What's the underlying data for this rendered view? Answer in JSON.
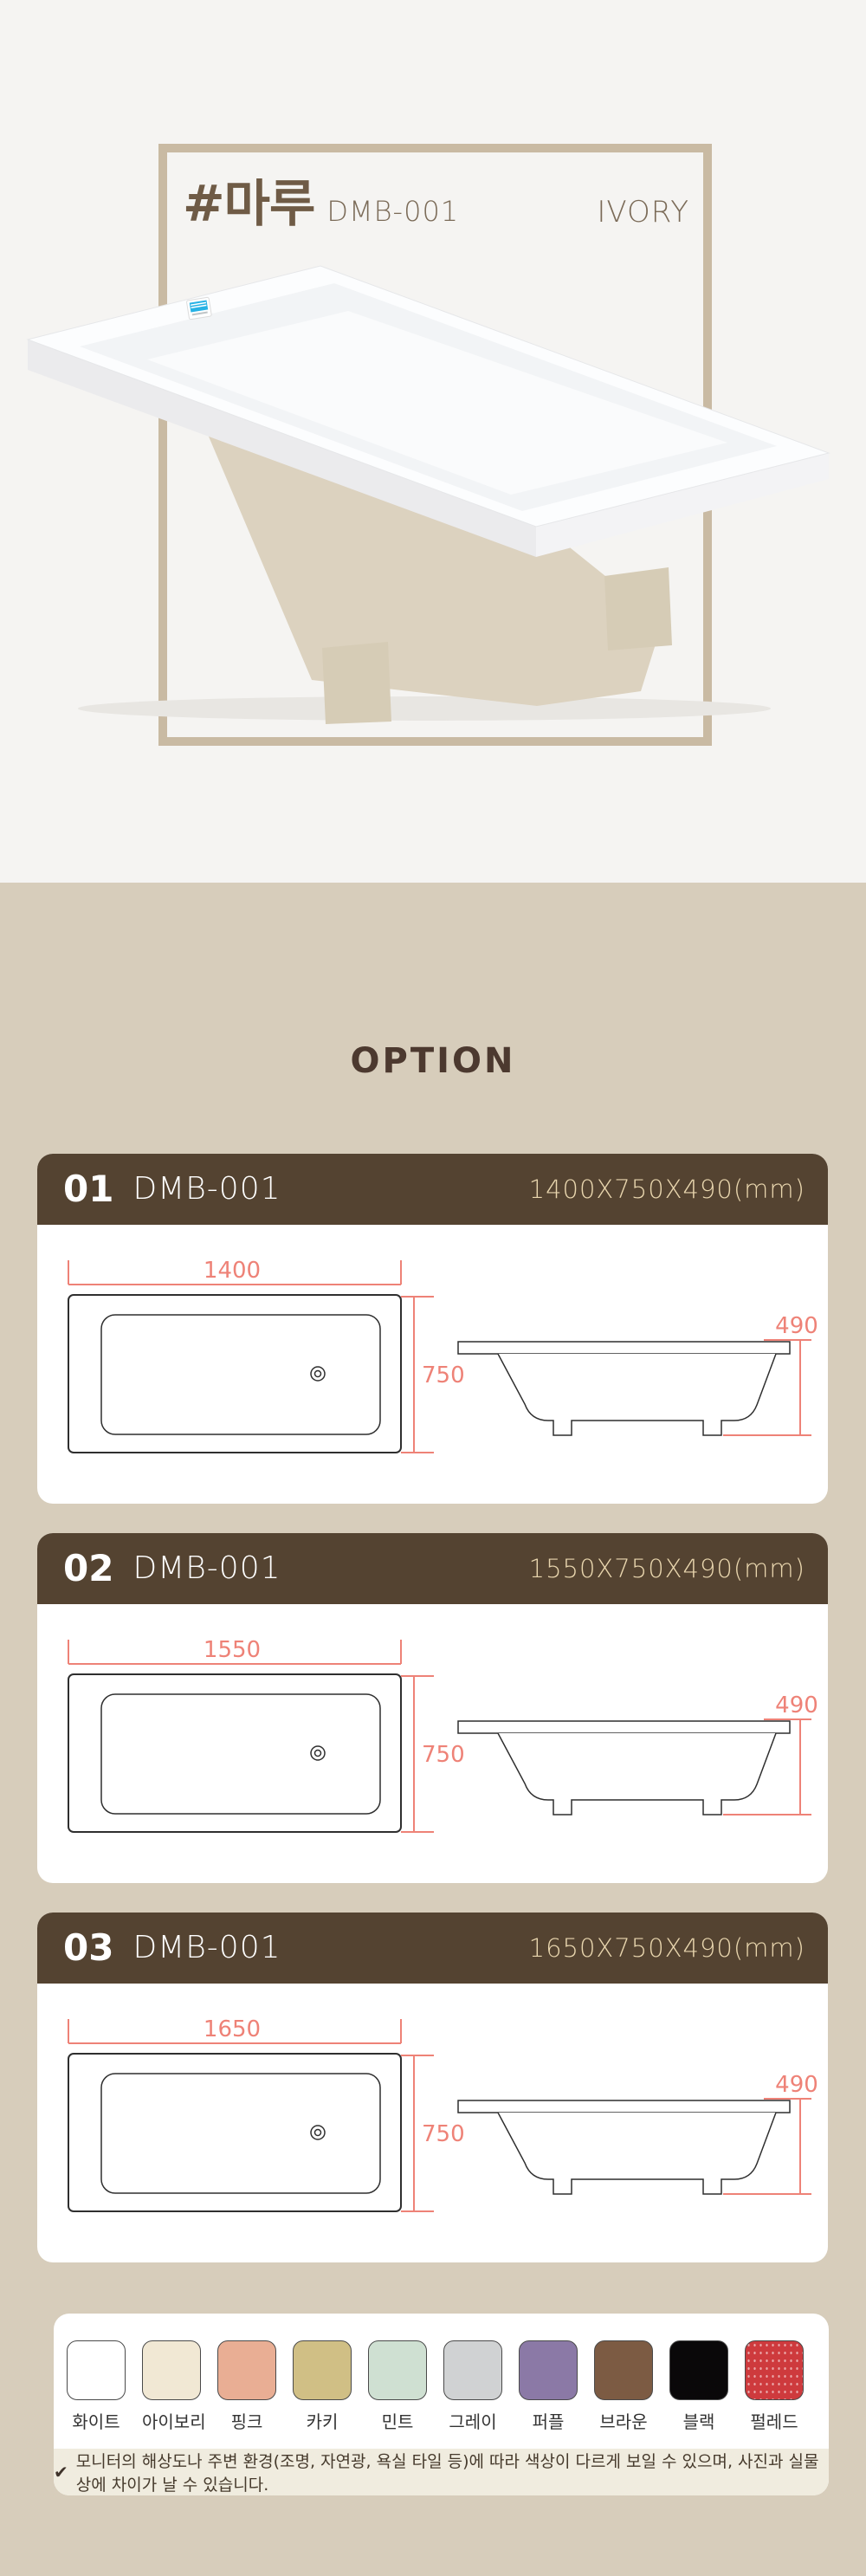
{
  "colors": {
    "page_top_bg": "#f5f4f2",
    "section_bg": "#d7cdbb",
    "frame_border": "#c9baa3",
    "card_header_bg": "#544331",
    "dimension_accent": "#ee8277",
    "size_text": "#e9d6ae",
    "title_brown": "#6f5b46",
    "option_title_color": "#4c392f",
    "note_bar_bg": "#f0ecdf"
  },
  "header": {
    "hash_title": "#마루",
    "model": "DMB-001",
    "finish_label": "IVORY"
  },
  "section_title": "OPTION",
  "options": [
    {
      "number": "01",
      "model": "DMB-001",
      "size": "1400X750X490(mm)",
      "top_width": "1400",
      "top_depth": "750",
      "side_height": "490"
    },
    {
      "number": "02",
      "model": "DMB-001",
      "size": "1550X750X490(mm)",
      "top_width": "1550",
      "top_depth": "750",
      "side_height": "490"
    },
    {
      "number": "03",
      "model": "DMB-001",
      "size": "1650X750X490(mm)",
      "top_width": "1650",
      "top_depth": "750",
      "side_height": "490"
    }
  ],
  "palette": {
    "swatches": [
      {
        "label": "화이트",
        "color": "#ffffff"
      },
      {
        "label": "아이보리",
        "color": "#f1e8d4"
      },
      {
        "label": "핑크",
        "color": "#e9ae94"
      },
      {
        "label": "카키",
        "color": "#d0bf85"
      },
      {
        "label": "민트",
        "color": "#cfe0d2"
      },
      {
        "label": "그레이",
        "color": "#d0d2d3"
      },
      {
        "label": "퍼플",
        "color": "#8b79a6"
      },
      {
        "label": "브라운",
        "color": "#7c5b43"
      },
      {
        "label": "블랙",
        "color": "#0a0809"
      },
      {
        "label": "펄레드",
        "color": "#ce3a3d",
        "texture": "pearl"
      }
    ],
    "note_icon": "✔",
    "note": "모니터의 해상도나 주변 환경(조명, 자연광, 욕실 타일 등)에 따라 색상이 다르게 보일 수 있으며, 사진과 실물상에 차이가 날 수 있습니다."
  }
}
